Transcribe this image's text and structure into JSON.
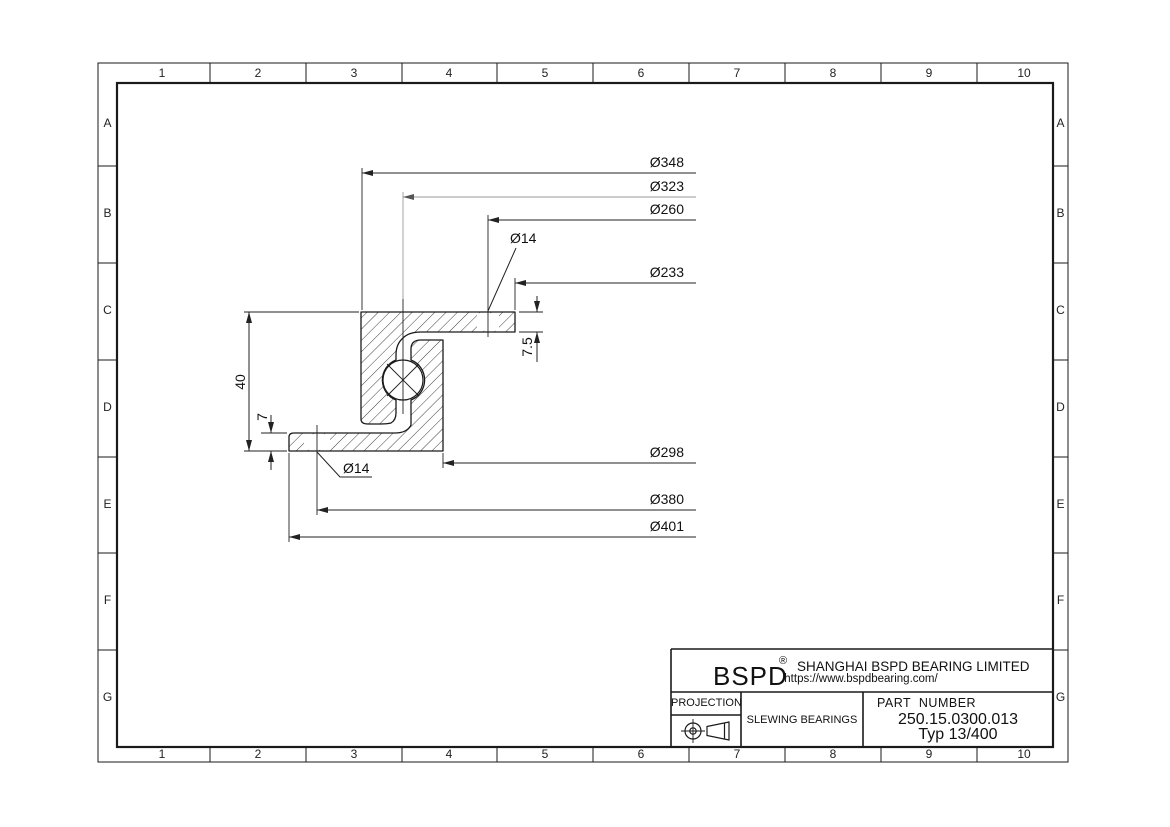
{
  "sheet": {
    "columns": [
      "1",
      "2",
      "3",
      "4",
      "5",
      "6",
      "7",
      "8",
      "9",
      "10"
    ],
    "rows": [
      "A",
      "B",
      "C",
      "D",
      "E",
      "F",
      "G"
    ]
  },
  "drawing": {
    "dims": {
      "d348": "Ø348",
      "d323": "Ø323",
      "d260": "Ø260",
      "d233": "Ø233",
      "d298": "Ø298",
      "d380": "Ø380",
      "d401": "Ø401",
      "hole_top": "Ø14",
      "hole_bottom": "Ø14",
      "overall_height": "40",
      "bottom_flange_thickness": "7",
      "top_flange_thickness": "7.5"
    }
  },
  "title_block": {
    "brand": "BSPD",
    "registered": "®",
    "company": "SHANGHAI BSPD BEARING LIMITED",
    "website": "https://www.bspdbearing.com/",
    "projection_label": "PROJECTION",
    "category": "SLEWING BEARINGS",
    "part_number_label": "PART  NUMBER",
    "part_number": "250.15.0300.013",
    "type_label": "Typ 13/400"
  },
  "colors": {
    "line": "#1a1a1a",
    "dim_alt": "#9a9a9a",
    "background": "#ffffff"
  }
}
